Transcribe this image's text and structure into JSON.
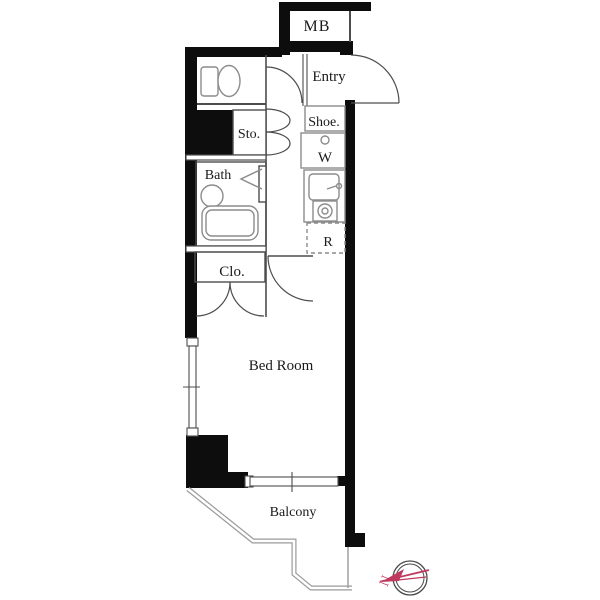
{
  "plan": {
    "labels": {
      "mb": "MB",
      "entry": "Entry",
      "shoe": "Shoe.",
      "washer": "W",
      "storage": "Sto.",
      "bath": "Bath",
      "closet": "Clo.",
      "refrigerator": "R",
      "bedroom": "Bed Room",
      "balcony": "Balcony"
    },
    "compass": {
      "north_label": "N"
    },
    "colors": {
      "wall": "#0d0d0d",
      "line": "#4d4d4d",
      "fixture": "#8c8c8c",
      "outline": "#9a9a9a",
      "compass_accent": "#bf3a5f",
      "background": "#ffffff"
    }
  }
}
